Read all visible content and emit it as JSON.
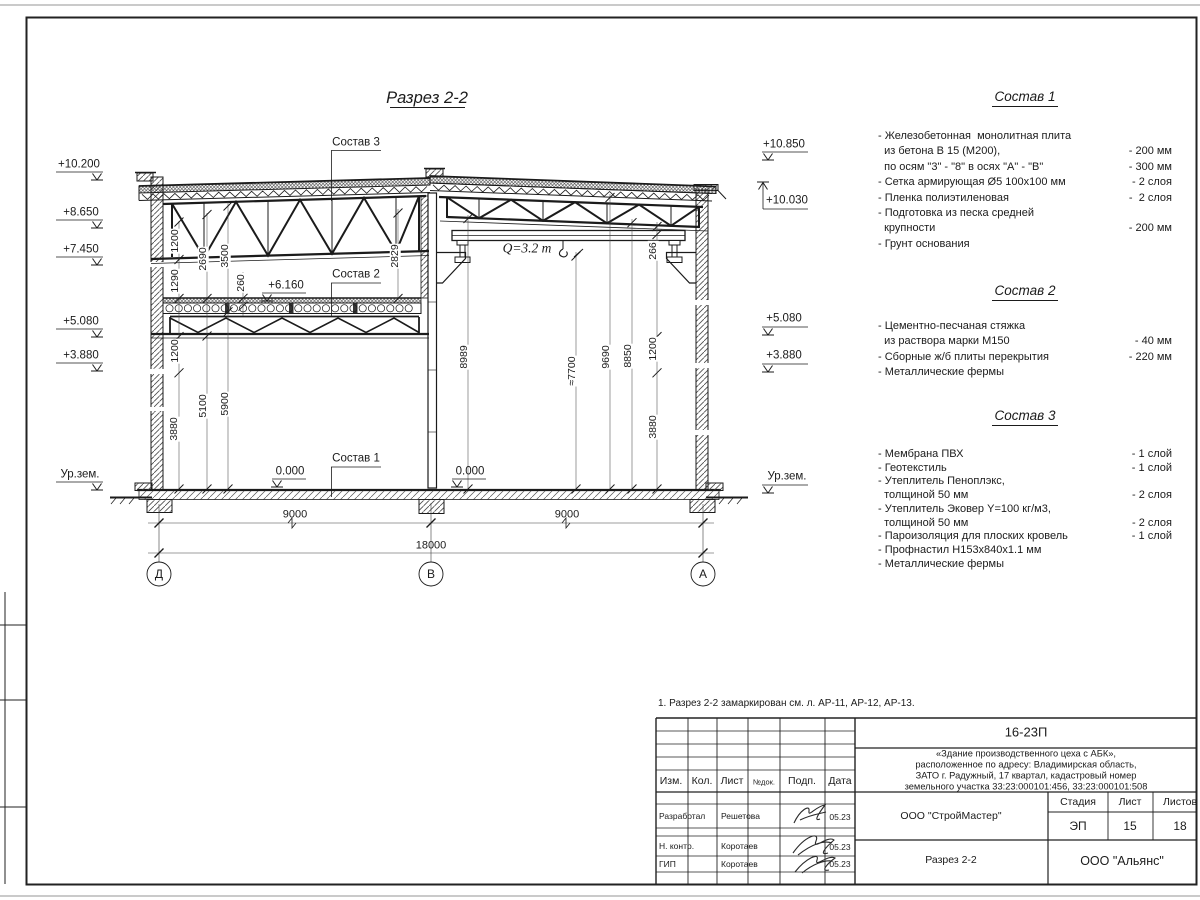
{
  "sheet": {
    "note": "1. Разрез 2-2 замаркирован см. л. АР-11, АР-12, АР-13.",
    "titleblock": {
      "doc_code": "16-23П",
      "desc1": "«Здание производственного цеха с АБК»,",
      "desc2": "расположенное по адресу: Владимирская область,",
      "desc3": "ЗАТО г. Радужный, 17 квартал, кадастровый номер",
      "desc4": "земельного участка 33:23:000101:456, 33:23:000101:508",
      "col_izm": "Изм.",
      "col_kol": "Кол.",
      "col_list": "Лист",
      "col_ndok": "№док.",
      "col_podp": "Подп.",
      "col_data": "Дата",
      "rows": [
        {
          "role": "Разработал",
          "name": "Решетова",
          "date": "05.23"
        },
        {
          "role": "Н. контр.",
          "name": "Коротаев",
          "date": "05.23"
        },
        {
          "role": "ГИП",
          "name": "Коротаев",
          "date": "05.23"
        }
      ],
      "org_designer": "ООО \"СтройМастер\"",
      "sheet_title": "Разрез 2-2",
      "stage_label": "Стадия",
      "stage": "ЭП",
      "list_label": "Лист",
      "sheet_no": "15",
      "listov_label": "Листов",
      "sheets_total": "18",
      "org_customer": "ООО \"Альянс\""
    }
  },
  "drawing": {
    "labels": [
      {
        "n": "drawing-title",
        "t": "Разрез 2-2",
        "x": 427,
        "y": 98,
        "s": 16.5,
        "i": 1
      },
      {
        "n": "leader-label-sostav-3",
        "t": "Состав 3",
        "x": 356,
        "y": 143,
        "s": 11.5
      },
      {
        "n": "leader-label-sostav-2",
        "t": "Состав 2",
        "x": 356,
        "y": 275,
        "s": 11.5
      },
      {
        "n": "leader-label-sostav-1",
        "t": "Состав 1",
        "x": 356,
        "y": 459,
        "s": 11.5
      },
      {
        "n": "elev-left-1",
        "t": "+10.200",
        "x": 79,
        "y": 165
      },
      {
        "n": "elev-left-2",
        "t": "+8.650",
        "x": 81,
        "y": 213
      },
      {
        "n": "elev-left-3",
        "t": "+7.450",
        "x": 81,
        "y": 250
      },
      {
        "n": "elev-left-4",
        "t": "+5.080",
        "x": 81,
        "y": 322
      },
      {
        "n": "elev-left-5",
        "t": "+3.880",
        "x": 81,
        "y": 356
      },
      {
        "n": "elev-left-ground",
        "t": "Ур.зем.",
        "x": 80,
        "y": 475
      },
      {
        "n": "elev-right-1",
        "t": "+10.850",
        "x": 784,
        "y": 145
      },
      {
        "n": "elev-right-2",
        "t": "+10.030",
        "x": 787,
        "y": 201
      },
      {
        "n": "elev-right-3",
        "t": "+5.080",
        "x": 784,
        "y": 319
      },
      {
        "n": "elev-right-4",
        "t": "+3.880",
        "x": 784,
        "y": 356
      },
      {
        "n": "elev-right-ground",
        "t": "Ур.зем.",
        "x": 787,
        "y": 477
      },
      {
        "n": "elev-floor2",
        "t": "+6.160",
        "x": 286,
        "y": 286
      },
      {
        "n": "elev-zero-left",
        "t": "0.000",
        "x": 290,
        "y": 472
      },
      {
        "n": "elev-zero-right",
        "t": "0.000",
        "x": 470,
        "y": 472
      },
      {
        "n": "crane-capacity",
        "t": "Q=3.2 т",
        "x": 527,
        "y": 248,
        "s": 13.5,
        "i": 1,
        "f": 1
      },
      {
        "n": "dim-span-left",
        "t": "9000",
        "x": 295,
        "y": 515,
        "s": 11
      },
      {
        "n": "dim-span-right",
        "t": "9000",
        "x": 567,
        "y": 515,
        "s": 11
      },
      {
        "n": "dim-total",
        "t": "18000",
        "x": 431,
        "y": 546,
        "s": 11
      },
      {
        "n": "axis-bubble-d",
        "t": "Д",
        "x": 159,
        "y": 574,
        "s": 12
      },
      {
        "n": "axis-bubble-v",
        "t": "В",
        "x": 431,
        "y": 574,
        "s": 12
      },
      {
        "n": "axis-bubble-a",
        "t": "А",
        "x": 703,
        "y": 574,
        "s": 12
      },
      {
        "n": "dim-1200-a",
        "t": "1200",
        "x": 175,
        "y": 241,
        "r": 1,
        "s": 10.5,
        "bg": 1
      },
      {
        "n": "dim-2690",
        "t": "2690",
        "x": 203,
        "y": 259,
        "r": 1,
        "s": 10.5,
        "bg": 1
      },
      {
        "n": "dim-3500",
        "t": "3500",
        "x": 225,
        "y": 256,
        "r": 1,
        "s": 10.5,
        "bg": 1
      },
      {
        "n": "dim-1290",
        "t": "1290",
        "x": 175,
        "y": 281,
        "r": 1,
        "s": 10.5,
        "bg": 1
      },
      {
        "n": "dim-260",
        "t": "260",
        "x": 241,
        "y": 283,
        "r": 1,
        "s": 10.5,
        "bg": 1
      },
      {
        "n": "dim-2829",
        "t": "2829",
        "x": 395,
        "y": 256,
        "r": 1,
        "s": 10.5,
        "bg": 1
      },
      {
        "n": "dim-1200-b",
        "t": "1200",
        "x": 175,
        "y": 351,
        "r": 1,
        "s": 10.5,
        "bg": 1
      },
      {
        "n": "dim-5100",
        "t": "5100",
        "x": 203,
        "y": 406,
        "r": 1,
        "s": 10.5,
        "bg": 1
      },
      {
        "n": "dim-5900",
        "t": "5900",
        "x": 225,
        "y": 404,
        "r": 1,
        "s": 10.5,
        "bg": 1
      },
      {
        "n": "dim-3880-a",
        "t": "3880",
        "x": 174,
        "y": 429,
        "r": 1,
        "s": 10.5,
        "bg": 1
      },
      {
        "n": "dim-266",
        "t": "266",
        "x": 653,
        "y": 251,
        "r": 1,
        "s": 10.5,
        "bg": 1
      },
      {
        "n": "dim-8989",
        "t": "8989",
        "x": 464,
        "y": 357,
        "r": 1,
        "s": 10.5,
        "bg": 1
      },
      {
        "n": "dim-7700",
        "t": "≈7700",
        "x": 572,
        "y": 371,
        "r": 1,
        "s": 10.5,
        "bg": 1
      },
      {
        "n": "dim-9690",
        "t": "9690",
        "x": 606,
        "y": 357,
        "r": 1,
        "s": 10.5,
        "bg": 1
      },
      {
        "n": "dim-8850",
        "t": "8850",
        "x": 628,
        "y": 356,
        "r": 1,
        "s": 10.5,
        "bg": 1
      },
      {
        "n": "dim-1200-c",
        "t": "1200",
        "x": 653,
        "y": 349,
        "r": 1,
        "s": 10.5,
        "bg": 1
      },
      {
        "n": "dim-3880-b",
        "t": "3880",
        "x": 653,
        "y": 427,
        "r": 1,
        "s": 10.5,
        "bg": 1
      }
    ]
  },
  "compositions": [
    {
      "title": "Состав 1",
      "top": 89,
      "gap": 25,
      "lh": 15.4,
      "lines": [
        {
          "t": "- Железобетонная  монолитная плита",
          "v": ""
        },
        {
          "t": "  из бетона В 15 (М200),",
          "v": "- 200 мм"
        },
        {
          "t": "  по осям \"3\" - \"8\" в осях \"А\" - \"В\"",
          "v": "- 300 мм"
        },
        {
          "t": "- Сетка армирующая Ø5 100х100 мм",
          "v": "- 2 слоя"
        },
        {
          "t": "- Пленка полиэтиленовая",
          "v": "-  2 слоя"
        },
        {
          "t": "- Подготовка из песка средней",
          "v": ""
        },
        {
          "t": "  крупности",
          "v": "- 200 мм"
        },
        {
          "t": "- Грунт основания",
          "v": ""
        }
      ]
    },
    {
      "title": "Состав 2",
      "top": 283,
      "gap": 21,
      "lh": 15.4,
      "lines": [
        {
          "t": "- Цементно-песчаная стяжка",
          "v": ""
        },
        {
          "t": "  из раствора марки М150",
          "v": "- 40 мм"
        },
        {
          "t": "- Сборные ж/б плиты перекрытия",
          "v": "- 220 мм"
        },
        {
          "t": "- Металлические фермы",
          "v": ""
        }
      ]
    },
    {
      "title": "Состав 3",
      "top": 408,
      "gap": 25,
      "lh": 13.7,
      "lines": [
        {
          "t": "- Мембрана ПВХ",
          "v": "- 1 слой"
        },
        {
          "t": "- Геотекстиль",
          "v": "- 1 слой"
        },
        {
          "t": "- Утеплитель Пеноплэкс,",
          "v": ""
        },
        {
          "t": "  толщиной 50 мм",
          "v": "- 2 слоя"
        },
        {
          "t": "- Утеплитель Эковер Y=100 кг/м3,",
          "v": ""
        },
        {
          "t": "  толщиной 50 мм",
          "v": "- 2 слоя"
        },
        {
          "t": "- Пароизоляция для плоских кровель",
          "v": "- 1 слой"
        },
        {
          "t": "- Профнастил Н153х840х1.1 мм",
          "v": ""
        },
        {
          "t": "- Металлические фермы",
          "v": ""
        }
      ]
    }
  ]
}
